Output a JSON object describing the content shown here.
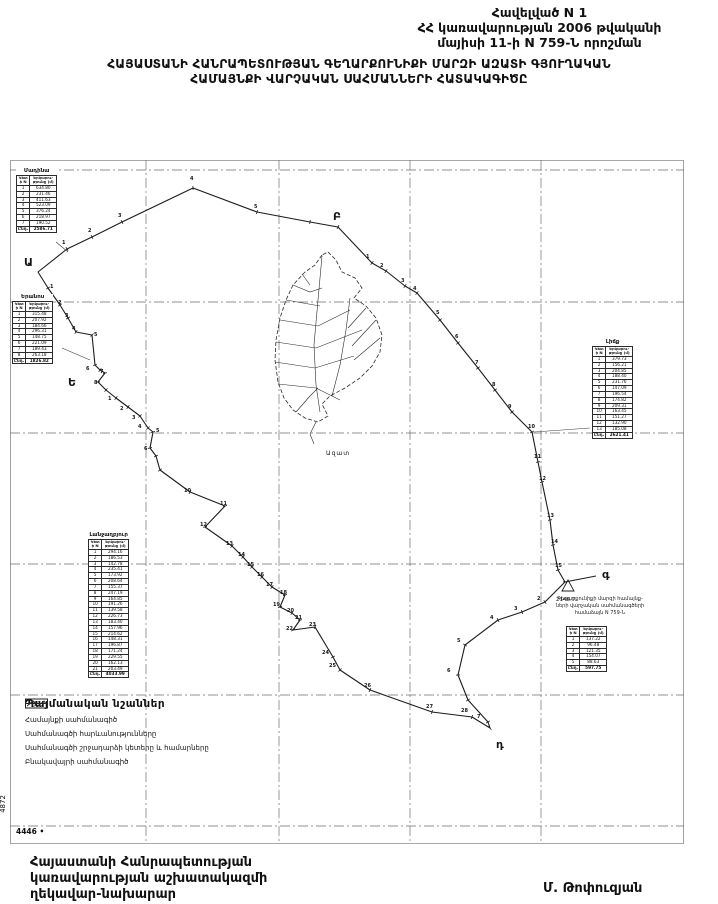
{
  "header": {
    "line1": "Հավելված N 1",
    "line2": "ՀՀ կառավարության 2006 թվականի",
    "line3": "մայիսի 11-ի N 759-Ն որոշման"
  },
  "title": {
    "line1": "ՀԱՅԱՍՏԱՆԻ ՀԱՆՐԱՊԵՏՈՒԹՅԱՆ ԳԵՂԱՐՔՈՒՆԻՔԻ ՄԱՐԶԻ ԱԶԱՏԻ ԳՅՈՒՂԱԿԱՆ",
    "line2": "ՀԱՄԱՅՆՔԻ ՎԱՐՉԱԿԱՆ ՍԱՀՄԱՆՆԵՐԻ ՀԱՏԱԿԱԳԻԾԸ"
  },
  "map": {
    "settlement_name": "Ազատ",
    "benchmark_label": "2146.7",
    "note": {
      "line1": "Գեղարքունիքի մարզի համայնք-",
      "line2": "ների վարչական սահմանագծերի",
      "line3": "համաձայն N 759-Ն"
    },
    "tables": [
      {
        "title": "Մադինա",
        "col1": "Կետի N",
        "col2": "Երկարու-թյունը (մ)",
        "total_label": "Ընդ.",
        "rows": [
          [
            "1",
            "634.80"
          ],
          [
            "2",
            "231.46"
          ],
          [
            "3",
            "411.63"
          ],
          [
            "4",
            "523.09"
          ],
          [
            "5",
            "376.24"
          ],
          [
            "6",
            "218.97"
          ],
          [
            "7",
            "190.52"
          ]
        ],
        "total": "2586.71"
      },
      {
        "title": "Երանոս",
        "col1": "Կետի N",
        "col2": "Երկարու-թյունը (մ)",
        "total_label": "Ընդ.",
        "rows": [
          [
            "1",
            "315.48"
          ],
          [
            "2",
            "207.92"
          ],
          [
            "3",
            "184.66"
          ],
          [
            "4",
            "296.31"
          ],
          [
            "5",
            "148.75"
          ],
          [
            "6",
            "221.09"
          ],
          [
            "7",
            "189.43"
          ],
          [
            "8",
            "263.18"
          ]
        ],
        "total": "1826.82"
      },
      {
        "title": "Լիճք",
        "col1": "Կետի N",
        "col2": "Երկարու-թյունը (մ)",
        "total_label": "Ընդ.",
        "rows": [
          [
            "1",
            "379.73"
          ],
          [
            "2",
            "156.21"
          ],
          [
            "3",
            "204.85"
          ],
          [
            "4",
            "188.40"
          ],
          [
            "5",
            "231.76"
          ],
          [
            "6",
            "147.09"
          ],
          [
            "7",
            "196.54"
          ],
          [
            "8",
            "174.82"
          ],
          [
            "9",
            "209.31"
          ],
          [
            "10",
            "163.45"
          ],
          [
            "11",
            "151.27"
          ],
          [
            "12",
            "132.90"
          ],
          [
            "13",
            "185.08"
          ]
        ],
        "total": "2621.41"
      },
      {
        "title": "Լանջաղբյուր",
        "col1": "Կետի N",
        "col2": "Երկարու-թյունը (մ)",
        "total_label": "Ընդ.",
        "rows": [
          [
            "1",
            "294.16"
          ],
          [
            "2",
            "186.53"
          ],
          [
            "3",
            "142.78"
          ],
          [
            "4",
            "235.41"
          ],
          [
            "5",
            "173.92"
          ],
          [
            "6",
            "208.64"
          ],
          [
            "7",
            "155.37"
          ],
          [
            "8",
            "247.19"
          ],
          [
            "9",
            "164.85"
          ],
          [
            "10",
            "191.26"
          ],
          [
            "11",
            "139.58"
          ],
          [
            "12",
            "226.73"
          ],
          [
            "13",
            "183.40"
          ],
          [
            "14",
            "157.96"
          ],
          [
            "15",
            "214.62"
          ],
          [
            "16",
            "148.31"
          ],
          [
            "17",
            "196.87"
          ],
          [
            "18",
            "171.24"
          ],
          [
            "19",
            "229.55"
          ],
          [
            "20",
            "162.13"
          ],
          [
            "21",
            "203.49"
          ]
        ],
        "total": "4033.99"
      },
      {
        "title": "",
        "col1": "Կետի N",
        "col2": "Երկարու-թյունը (մ)",
        "total_label": "Ընդ.",
        "rows": [
          [
            "1",
            "137.22"
          ],
          [
            "2",
            "96.48"
          ],
          [
            "3",
            "121.35"
          ],
          [
            "4",
            "154.07"
          ],
          [
            "5",
            "88.63"
          ]
        ],
        "total": "597.75"
      }
    ],
    "labels": [
      {
        "t": "Ա",
        "x": 14,
        "y": 96,
        "c": "L"
      },
      {
        "t": "Բ",
        "x": 323,
        "y": 50,
        "c": "L"
      },
      {
        "t": "գ",
        "x": 592,
        "y": 408,
        "c": "L"
      },
      {
        "t": "դ",
        "x": 486,
        "y": 578,
        "c": "L"
      },
      {
        "t": "Ե",
        "x": 58,
        "y": 216,
        "c": "L"
      },
      {
        "t": "2146.7",
        "x": 546,
        "y": 437,
        "c": "bm"
      },
      {
        "t": "Ազատ",
        "x": 316,
        "y": 290,
        "c": "st"
      },
      {
        "t": "1",
        "x": 52,
        "y": 80
      },
      {
        "t": "2",
        "x": 78,
        "y": 68
      },
      {
        "t": "3",
        "x": 108,
        "y": 53
      },
      {
        "t": "4",
        "x": 180,
        "y": 16
      },
      {
        "t": "5",
        "x": 244,
        "y": 44
      },
      {
        "t": "1",
        "x": 356,
        "y": 94
      },
      {
        "t": "2",
        "x": 370,
        "y": 103
      },
      {
        "t": "3",
        "x": 391,
        "y": 118
      },
      {
        "t": "4",
        "x": 403,
        "y": 126
      },
      {
        "t": "5",
        "x": 426,
        "y": 150
      },
      {
        "t": "6",
        "x": 445,
        "y": 174
      },
      {
        "t": "7",
        "x": 465,
        "y": 200
      },
      {
        "t": "8",
        "x": 482,
        "y": 222
      },
      {
        "t": "9",
        "x": 498,
        "y": 244
      },
      {
        "t": "10",
        "x": 518,
        "y": 264
      },
      {
        "t": "11",
        "x": 524,
        "y": 294
      },
      {
        "t": "12",
        "x": 529,
        "y": 316
      },
      {
        "t": "13",
        "x": 537,
        "y": 353
      },
      {
        "t": "14",
        "x": 541,
        "y": 379
      },
      {
        "t": "15",
        "x": 545,
        "y": 403
      },
      {
        "t": "2",
        "x": 527,
        "y": 436
      },
      {
        "t": "3",
        "x": 504,
        "y": 446
      },
      {
        "t": "4",
        "x": 480,
        "y": 455
      },
      {
        "t": "5",
        "x": 447,
        "y": 478
      },
      {
        "t": "6",
        "x": 437,
        "y": 508
      },
      {
        "t": "7",
        "x": 467,
        "y": 554
      },
      {
        "t": "24",
        "x": 312,
        "y": 490
      },
      {
        "t": "25",
        "x": 319,
        "y": 503
      },
      {
        "t": "26",
        "x": 354,
        "y": 523
      },
      {
        "t": "27",
        "x": 416,
        "y": 544
      },
      {
        "t": "28",
        "x": 451,
        "y": 548
      },
      {
        "t": "1",
        "x": 40,
        "y": 124
      },
      {
        "t": "2",
        "x": 48,
        "y": 140
      },
      {
        "t": "3",
        "x": 55,
        "y": 153
      },
      {
        "t": "4",
        "x": 62,
        "y": 166
      },
      {
        "t": "5",
        "x": 84,
        "y": 172
      },
      {
        "t": "6",
        "x": 76,
        "y": 206
      },
      {
        "t": "7",
        "x": 90,
        "y": 209
      },
      {
        "t": "8",
        "x": 84,
        "y": 220
      },
      {
        "t": "1",
        "x": 98,
        "y": 236
      },
      {
        "t": "2",
        "x": 110,
        "y": 246
      },
      {
        "t": "3",
        "x": 122,
        "y": 255
      },
      {
        "t": "4",
        "x": 128,
        "y": 264
      },
      {
        "t": "5",
        "x": 146,
        "y": 268
      },
      {
        "t": "6",
        "x": 134,
        "y": 286
      },
      {
        "t": "10",
        "x": 174,
        "y": 328
      },
      {
        "t": "11",
        "x": 210,
        "y": 341
      },
      {
        "t": "12",
        "x": 190,
        "y": 362
      },
      {
        "t": "13",
        "x": 216,
        "y": 381
      },
      {
        "t": "14",
        "x": 228,
        "y": 392
      },
      {
        "t": "15",
        "x": 237,
        "y": 402
      },
      {
        "t": "16",
        "x": 247,
        "y": 412
      },
      {
        "t": "17",
        "x": 256,
        "y": 422
      },
      {
        "t": "18",
        "x": 270,
        "y": 430
      },
      {
        "t": "19",
        "x": 263,
        "y": 442
      },
      {
        "t": "20",
        "x": 277,
        "y": 448
      },
      {
        "t": "21",
        "x": 285,
        "y": 455
      },
      {
        "t": "22",
        "x": 276,
        "y": 466
      },
      {
        "t": "23",
        "x": 299,
        "y": 462
      }
    ],
    "boundary": [
      [
        28,
        112
      ],
      [
        57,
        89
      ],
      [
        82,
        77
      ],
      [
        112,
        62
      ],
      [
        183,
        28
      ],
      [
        247,
        52
      ],
      [
        300,
        62
      ],
      [
        328,
        67
      ],
      [
        362,
        103
      ],
      [
        376,
        111
      ],
      [
        395,
        126
      ],
      [
        407,
        133
      ],
      [
        430,
        160
      ],
      [
        448,
        183
      ],
      [
        468,
        208
      ],
      [
        485,
        230
      ],
      [
        502,
        252
      ],
      [
        522,
        272
      ],
      [
        528,
        302
      ],
      [
        532,
        322
      ],
      [
        540,
        360
      ],
      [
        543,
        385
      ],
      [
        548,
        410
      ],
      [
        555,
        422
      ],
      [
        535,
        442
      ],
      [
        512,
        452
      ],
      [
        488,
        460
      ],
      [
        455,
        485
      ],
      [
        448,
        515
      ],
      [
        458,
        540
      ],
      [
        478,
        562
      ],
      [
        480,
        568
      ],
      [
        462,
        557
      ],
      [
        422,
        552
      ],
      [
        360,
        530
      ],
      [
        330,
        510
      ],
      [
        323,
        497
      ],
      [
        305,
        467
      ],
      [
        283,
        470
      ],
      [
        290,
        460
      ],
      [
        282,
        453
      ],
      [
        270,
        447
      ],
      [
        275,
        435
      ],
      [
        262,
        427
      ],
      [
        252,
        417
      ],
      [
        242,
        407
      ],
      [
        233,
        397
      ],
      [
        222,
        386
      ],
      [
        195,
        367
      ],
      [
        215,
        346
      ],
      [
        180,
        332
      ],
      [
        150,
        310
      ],
      [
        146,
        296
      ],
      [
        140,
        288
      ],
      [
        143,
        272
      ],
      [
        138,
        268
      ],
      [
        130,
        256
      ],
      [
        118,
        247
      ],
      [
        106,
        238
      ],
      [
        96,
        230
      ],
      [
        88,
        222
      ],
      [
        95,
        213
      ],
      [
        90,
        210
      ],
      [
        85,
        205
      ],
      [
        82,
        175
      ],
      [
        66,
        172
      ],
      [
        58,
        158
      ],
      [
        50,
        145
      ],
      [
        38,
        128
      ]
    ],
    "spur": [
      [
        555,
        422
      ],
      [
        586,
        416
      ]
    ],
    "leaders": [
      [
        [
          46,
          82
        ],
        [
          58,
          92
        ]
      ],
      [
        [
          52,
          188
        ],
        [
          80,
          200
        ]
      ],
      [
        [
          580,
          268
        ],
        [
          524,
          272
        ]
      ]
    ],
    "benchmark_tri": [
      [
        558,
        420
      ],
      [
        552,
        431
      ],
      [
        564,
        431
      ]
    ],
    "settlement": {
      "outline": [
        [
          312,
          95
        ],
        [
          305,
          105
        ],
        [
          295,
          112
        ],
        [
          283,
          125
        ],
        [
          276,
          140
        ],
        [
          270,
          158
        ],
        [
          266,
          180
        ],
        [
          265,
          200
        ],
        [
          268,
          222
        ],
        [
          274,
          238
        ],
        [
          283,
          250
        ],
        [
          295,
          258
        ],
        [
          308,
          262
        ],
        [
          318,
          256
        ],
        [
          312,
          244
        ],
        [
          320,
          236
        ],
        [
          335,
          228
        ],
        [
          350,
          218
        ],
        [
          362,
          206
        ],
        [
          370,
          192
        ],
        [
          372,
          175
        ],
        [
          366,
          158
        ],
        [
          356,
          146
        ],
        [
          344,
          138
        ],
        [
          352,
          128
        ],
        [
          345,
          118
        ],
        [
          332,
          112
        ],
        [
          326,
          100
        ],
        [
          318,
          92
        ]
      ],
      "lines": [
        [
          [
            312,
            96
          ],
          [
            308,
            140
          ],
          [
            304,
            185
          ],
          [
            306,
            225
          ],
          [
            310,
            252
          ]
        ],
        [
          [
            276,
            140
          ],
          [
            310,
            146
          ]
        ],
        [
          [
            270,
            160
          ],
          [
            308,
            166
          ],
          [
            340,
            150
          ]
        ],
        [
          [
            266,
            182
          ],
          [
            306,
            188
          ],
          [
            352,
            170
          ]
        ],
        [
          [
            265,
            202
          ],
          [
            305,
            208
          ],
          [
            344,
            196
          ]
        ],
        [
          [
            268,
            224
          ],
          [
            306,
            228
          ],
          [
            330,
            240
          ]
        ],
        [
          [
            283,
            125
          ],
          [
            300,
            132
          ],
          [
            312,
            128
          ]
        ],
        [
          [
            340,
            138
          ],
          [
            336,
            170
          ],
          [
            330,
            205
          ],
          [
            322,
            236
          ]
        ],
        [
          [
            356,
            148
          ],
          [
            338,
            168
          ]
        ],
        [
          [
            366,
            160
          ],
          [
            342,
            186
          ]
        ],
        [
          [
            370,
            178
          ],
          [
            344,
            200
          ]
        ],
        [
          [
            286,
            252
          ],
          [
            300,
            236
          ],
          [
            308,
            228
          ]
        ],
        [
          [
            292,
            114
          ],
          [
            300,
            125
          ]
        ],
        [
          [
            306,
            262
          ],
          [
            300,
            274
          ],
          [
            304,
            284
          ]
        ]
      ]
    }
  },
  "legend": {
    "title": "Պայմանական նշաններ",
    "items": [
      {
        "label": "Համայնքի սահմանագիծ"
      },
      {
        "label": "Սահմանագծի հարևանությունները"
      },
      {
        "box": "65",
        "label": "Սահմանագծի շրջադարձի կետերը և համարները"
      },
      {
        "label": "Բնակավայրի սահմանագիծ"
      }
    ]
  },
  "margins": {
    "bottom_left": "4446 •",
    "left_rotated": "4872"
  },
  "footer": {
    "line1": "Հայաստանի Հանրապետության",
    "line2": "կառավարության աշխատակազմի",
    "line3": "ղեկավար-նախարար",
    "signature": "Մ. Թոփուզյան"
  }
}
